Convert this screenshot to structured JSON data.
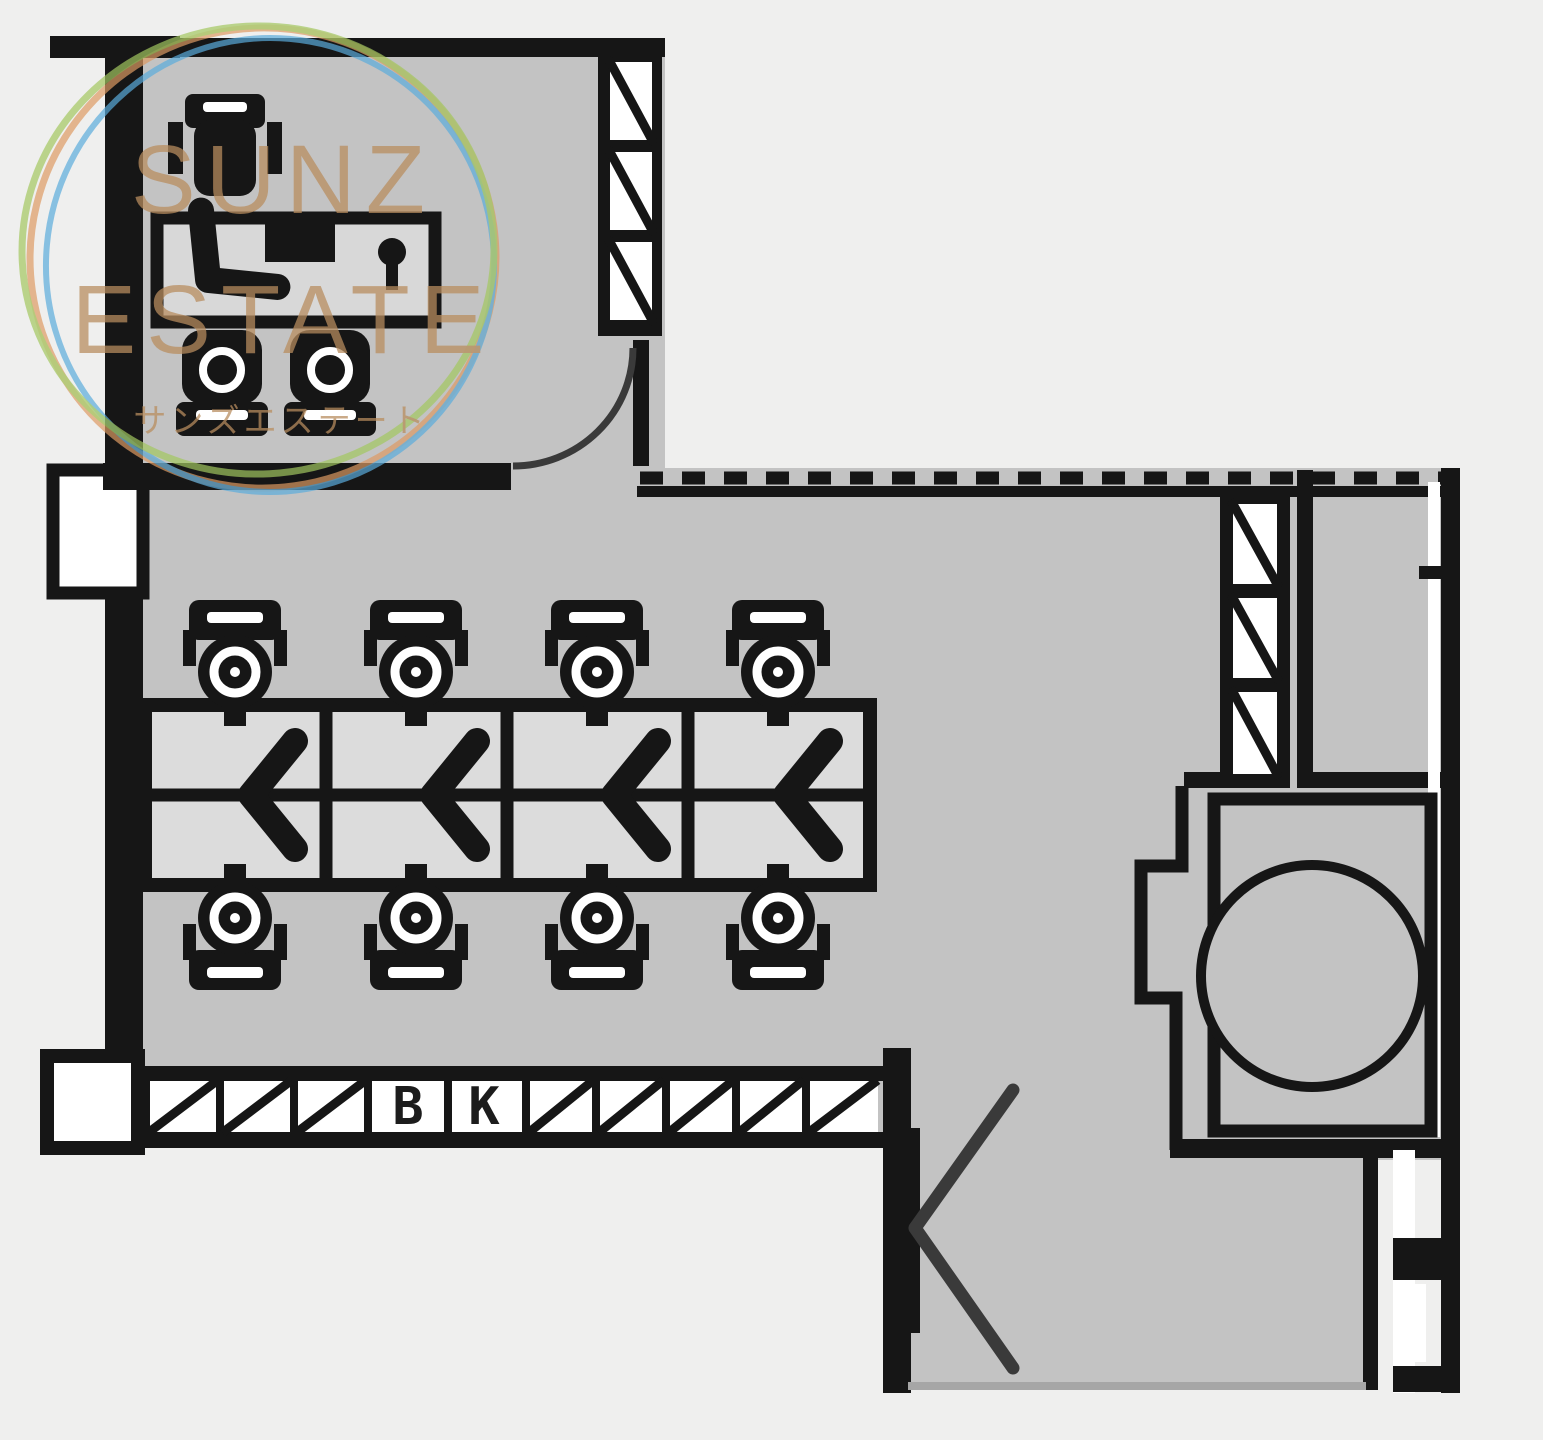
{
  "watermark": {
    "brand_line1": "SUNZ",
    "brand_line2": "ESTATE",
    "brand_caption": "サンズエステート"
  },
  "plan": {
    "bk_b": "B",
    "bk_k": "K"
  },
  "colors": {
    "outside": "#efefee",
    "floor": "#c3c3c3",
    "floor_light": "#dcdcdc",
    "desk_top": "#d8d8d8",
    "wall": "#161616",
    "paper": "#ffffff",
    "door": "#3a3a3a",
    "edge": "#a6a6a6",
    "ring_orange": "#dd9a63",
    "ring_blue": "#5aabdc",
    "ring_green": "#a2c75f",
    "brand_text": "#b98d5f"
  }
}
